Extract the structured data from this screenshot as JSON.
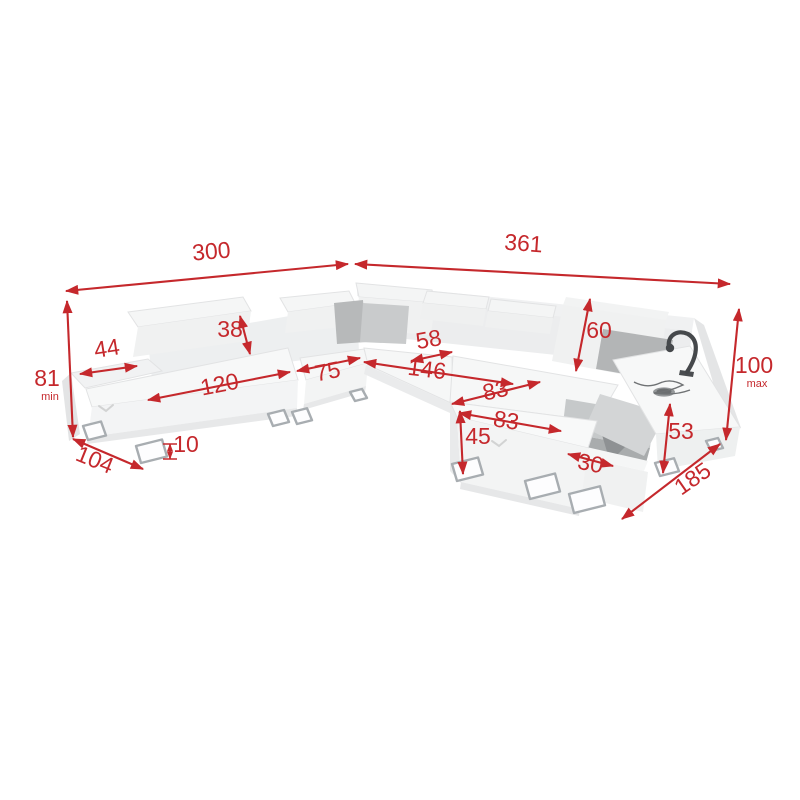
{
  "diagram": {
    "type": "sofa-dimension-diagram",
    "colors": {
      "dimension": "#c5282c",
      "sofa_body": "#f5f6f7",
      "sofa_shadow": "#e7e8e9",
      "pillow_dark": "#b3b5b6",
      "pillow_light": "#c9cbcc",
      "storage_interior": "#a9acad",
      "metal_leg": "#a8adb1",
      "lamp": "#45484b"
    },
    "dimensions": {
      "width_left": {
        "value": "300"
      },
      "width_right": {
        "value": "361"
      },
      "height_min": {
        "value": "81",
        "suffix": "min"
      },
      "shelf_width": {
        "value": "44"
      },
      "headrest_left_height": {
        "value": "38"
      },
      "seat_left_width": {
        "value": "120"
      },
      "seat_middle_width": {
        "value": "75"
      },
      "depth_left": {
        "value": "104"
      },
      "leg_height": {
        "value": "10"
      },
      "corner_seat_width": {
        "value": "58"
      },
      "seat_right_width": {
        "value": "146"
      },
      "headrest_right_height": {
        "value": "60"
      },
      "chaise_width_back": {
        "value": "83"
      },
      "chaise_width_front": {
        "value": "83"
      },
      "chaise_front_height": {
        "value": "45"
      },
      "storage_opening_width": {
        "value": "30"
      },
      "armrest_right_height": {
        "value": "53"
      },
      "height_max": {
        "value": "100",
        "suffix": "max"
      },
      "depth_right": {
        "value": "185"
      }
    }
  }
}
